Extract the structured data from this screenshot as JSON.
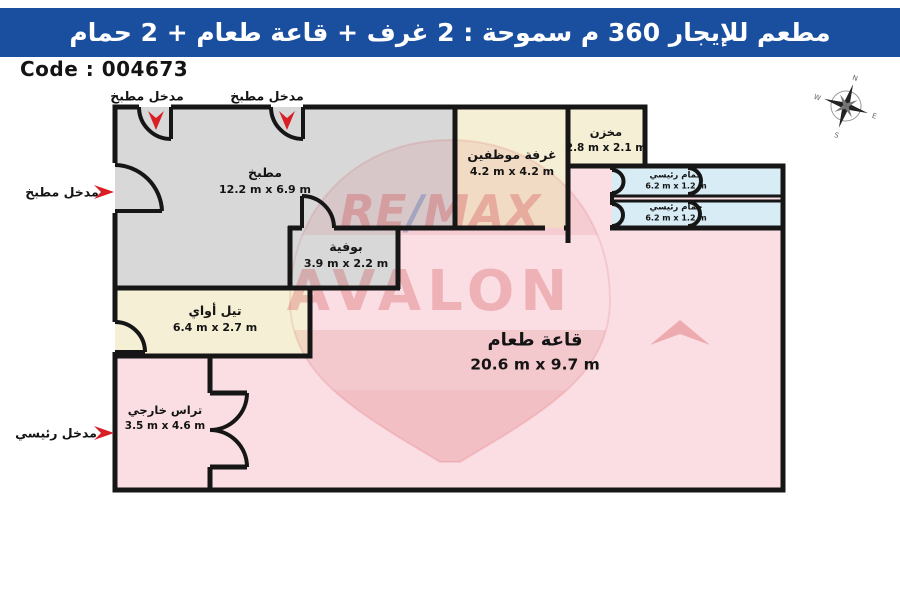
{
  "header": {
    "title": "مطعم للإيجار 360 م سموحة :  2 غرف + قاعة طعام + 2 حمام"
  },
  "code_label": "Code : 004673",
  "entrances": [
    {
      "label": "مدخل مطبخ",
      "direction": "down"
    },
    {
      "label": "مدخل مطبخ",
      "direction": "down"
    },
    {
      "label": "مدخل مطبخ",
      "direction": "right"
    },
    {
      "label": "مدخل رئيسي",
      "direction": "right"
    }
  ],
  "rooms": [
    {
      "name": "مطبخ",
      "dims": "12.2 m x 6.9 m",
      "fill": "#d8d8d8"
    },
    {
      "name": "غرفة موظفين",
      "dims": "4.2 m x 4.2 m",
      "fill": "#f5efd5"
    },
    {
      "name": "مخزن",
      "dims": "2.8 m x 2.1 m",
      "fill": "#f5efd5"
    },
    {
      "name": "حمام رئيسي",
      "dims": "6.2 m x 1.2 m",
      "fill": "#d7ecf4"
    },
    {
      "name": "حمام رئيسي",
      "dims": "6.2 m x 1.2 m",
      "fill": "#d7ecf4"
    },
    {
      "name": "بوفية",
      "dims": "3.9 m x 2.2 m",
      "fill": "#d8d8d8"
    },
    {
      "name": "تيل أواي",
      "dims": "6.4 m x 2.7 m",
      "fill": "#f5efd5"
    },
    {
      "name": "قاعة طعام",
      "dims": "20.6 m x 9.7 m",
      "fill": "#fadee3"
    },
    {
      "name": "تراس خارجي",
      "dims": "3.5 m x 4.6 m",
      "fill": "#fadee3"
    }
  ],
  "watermark": {
    "re": "RE",
    "slash": "/",
    "max": "MAX",
    "office": "AVALON"
  },
  "compass": {
    "north": "N",
    "east": "E",
    "south": "S",
    "west": "W"
  },
  "colors": {
    "header_bg": "#1a4f9f",
    "wall": "#161616",
    "arrow_red": "#d81f26",
    "dining_pink": "#fadee3",
    "kitchen_gray": "#d8d8d8",
    "cream": "#f5efd5",
    "bath_blue": "#d7ecf4",
    "watermark_red": "#cf3339",
    "watermark_blue": "#1f55a5"
  }
}
